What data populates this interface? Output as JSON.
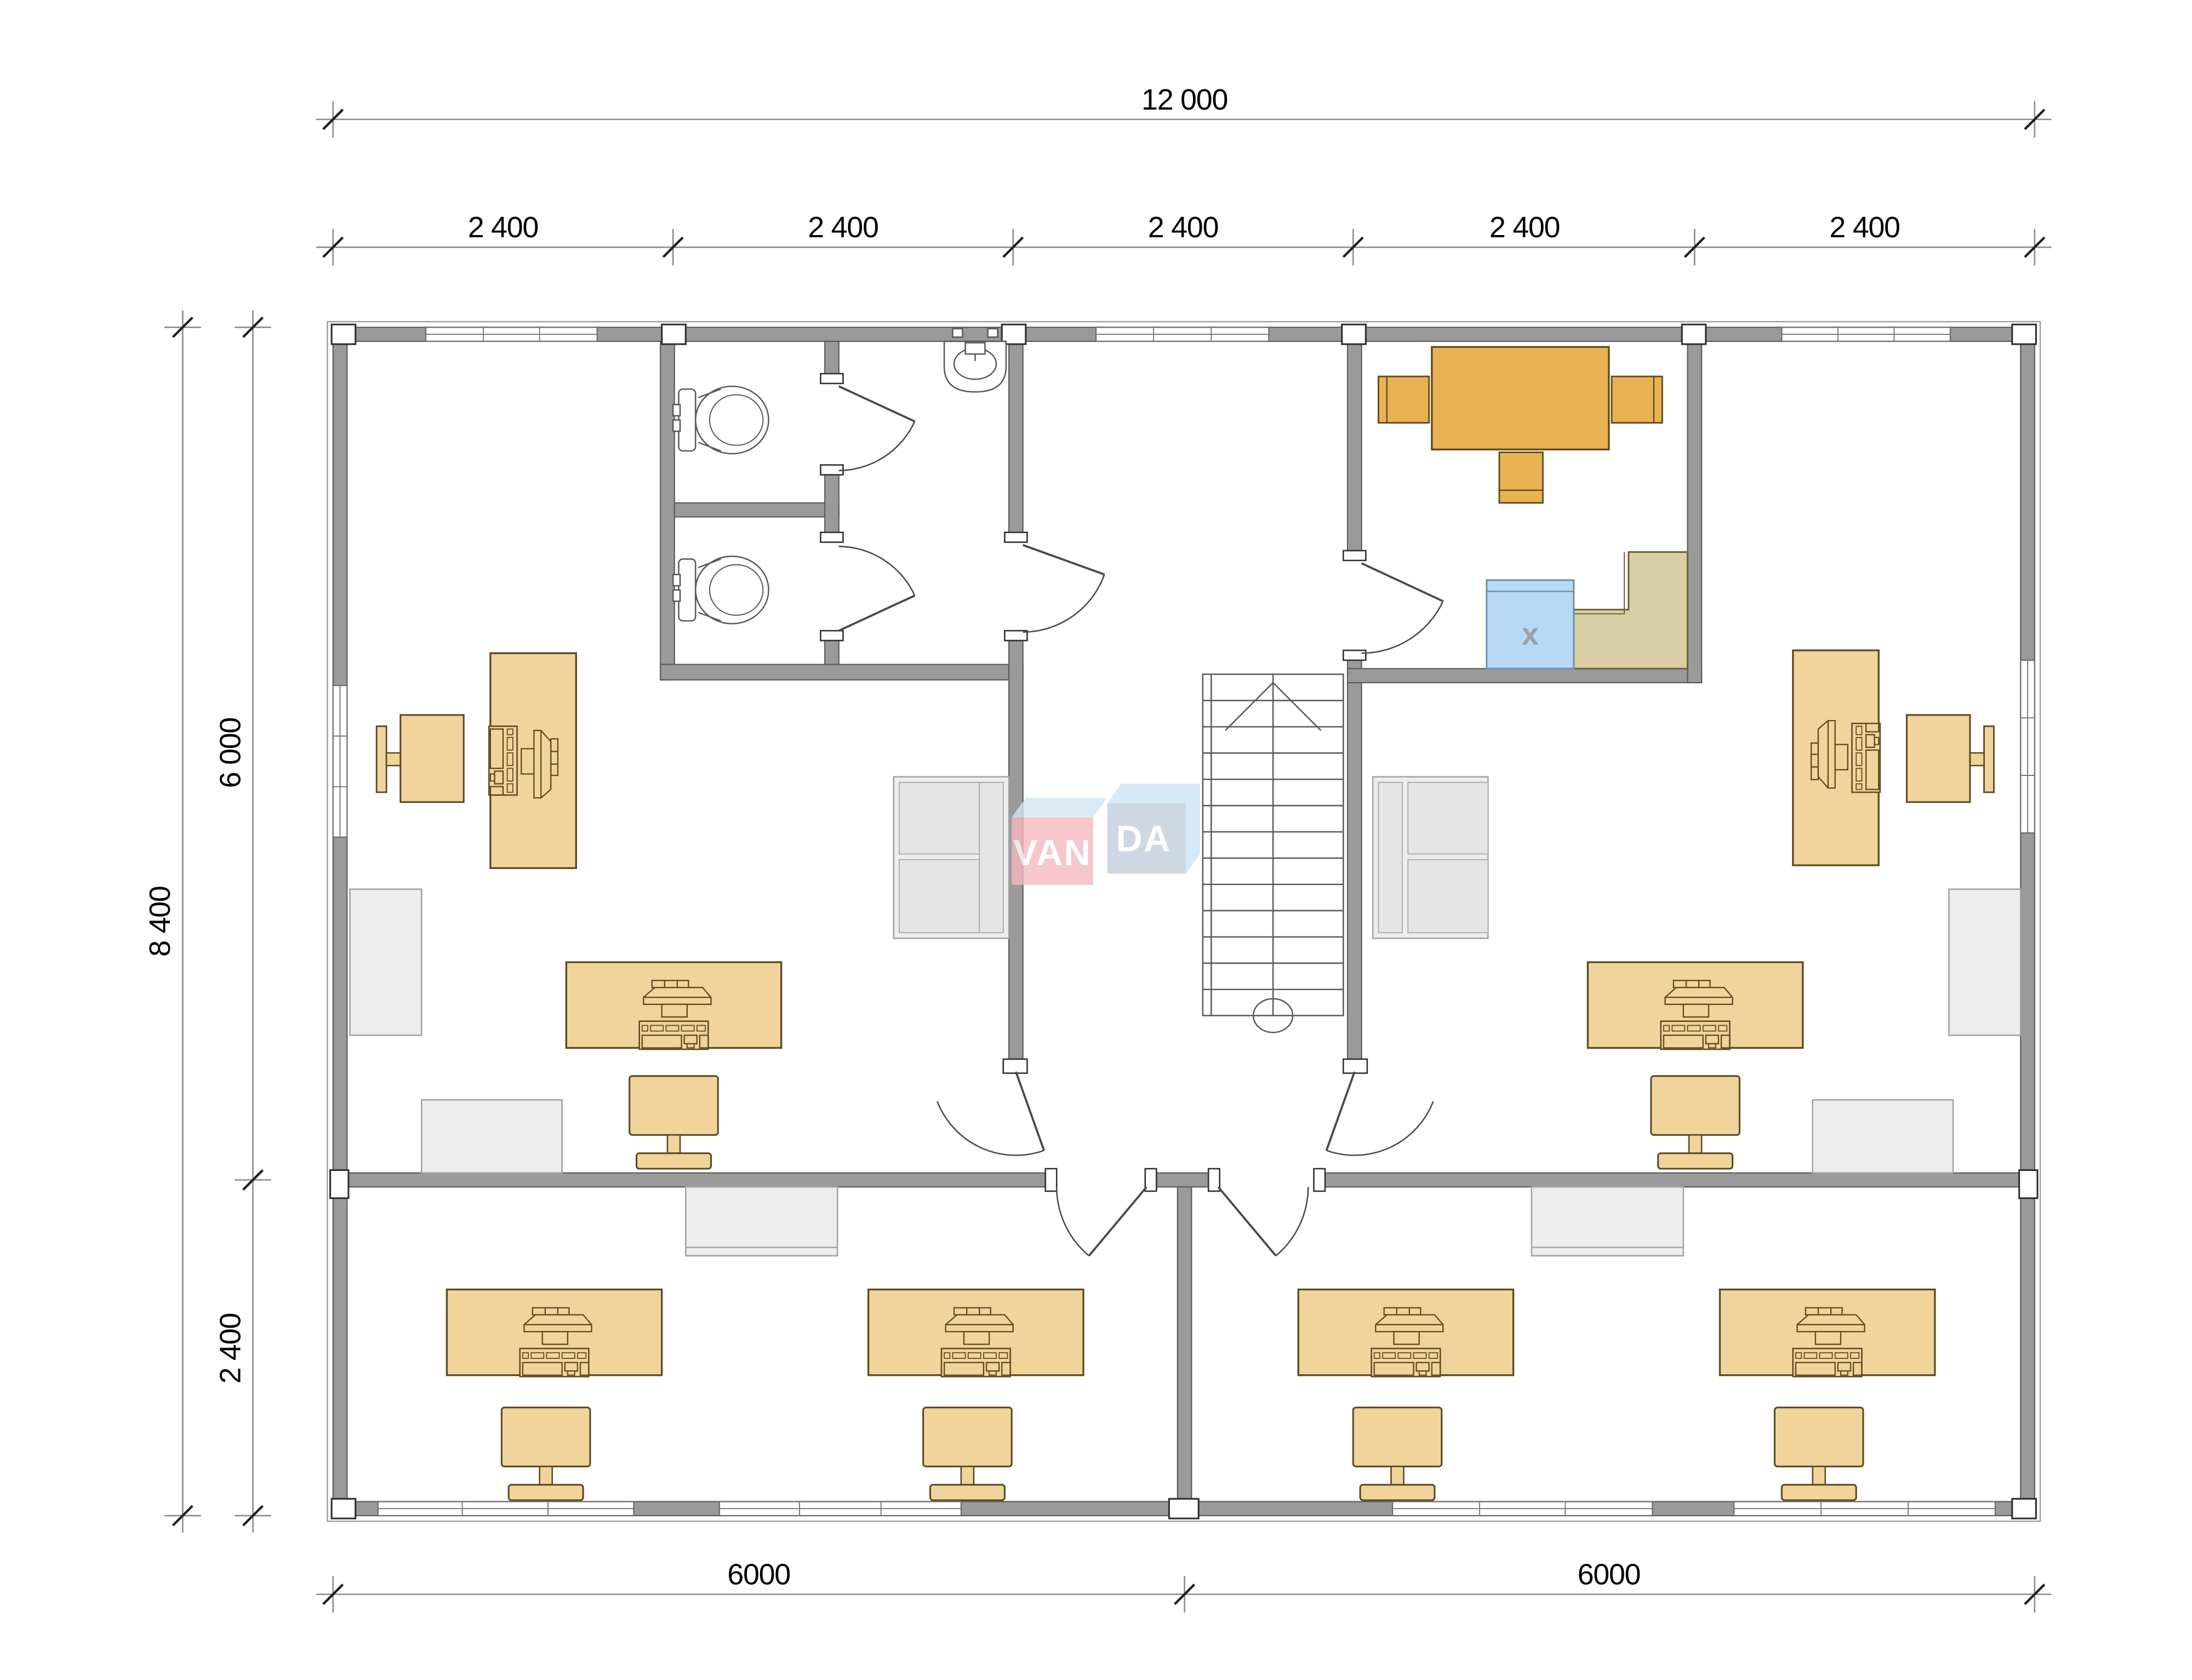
{
  "dimensions": {
    "top_total": "12 000",
    "top_segments": [
      "2 400",
      "2 400",
      "2 400",
      "2 400",
      "2 400"
    ],
    "left_total": "8 400",
    "left_upper": "6 000",
    "left_lower": "2 400",
    "bottom_left": "6000",
    "bottom_right": "6000"
  },
  "watermark": {
    "brand_left": "VAN",
    "brand_right": "DA"
  },
  "appliance": {
    "mark": "x"
  },
  "colors": {
    "wall": "#9a9a9a",
    "desk_tan": "#f1d49b",
    "desk_outline": "#5c4a22",
    "table_orange": "#e9b254",
    "appliance_blue": "#b8d9f4",
    "counter_khaki": "#d9cfa4",
    "furniture_gray": "#ededed",
    "logo_pink": "#f4b9bd",
    "logo_blue": "#cde4f4"
  },
  "furniture_manifest": {
    "computer_desks": 8,
    "desk_chairs": 8,
    "conference_table": 1,
    "conference_chairs": 3,
    "toilets": 2,
    "sinks": 1,
    "sofas": 2,
    "cabinets": 6,
    "appliance_with_x": 1,
    "l_counter": 1,
    "stairs": 1
  }
}
